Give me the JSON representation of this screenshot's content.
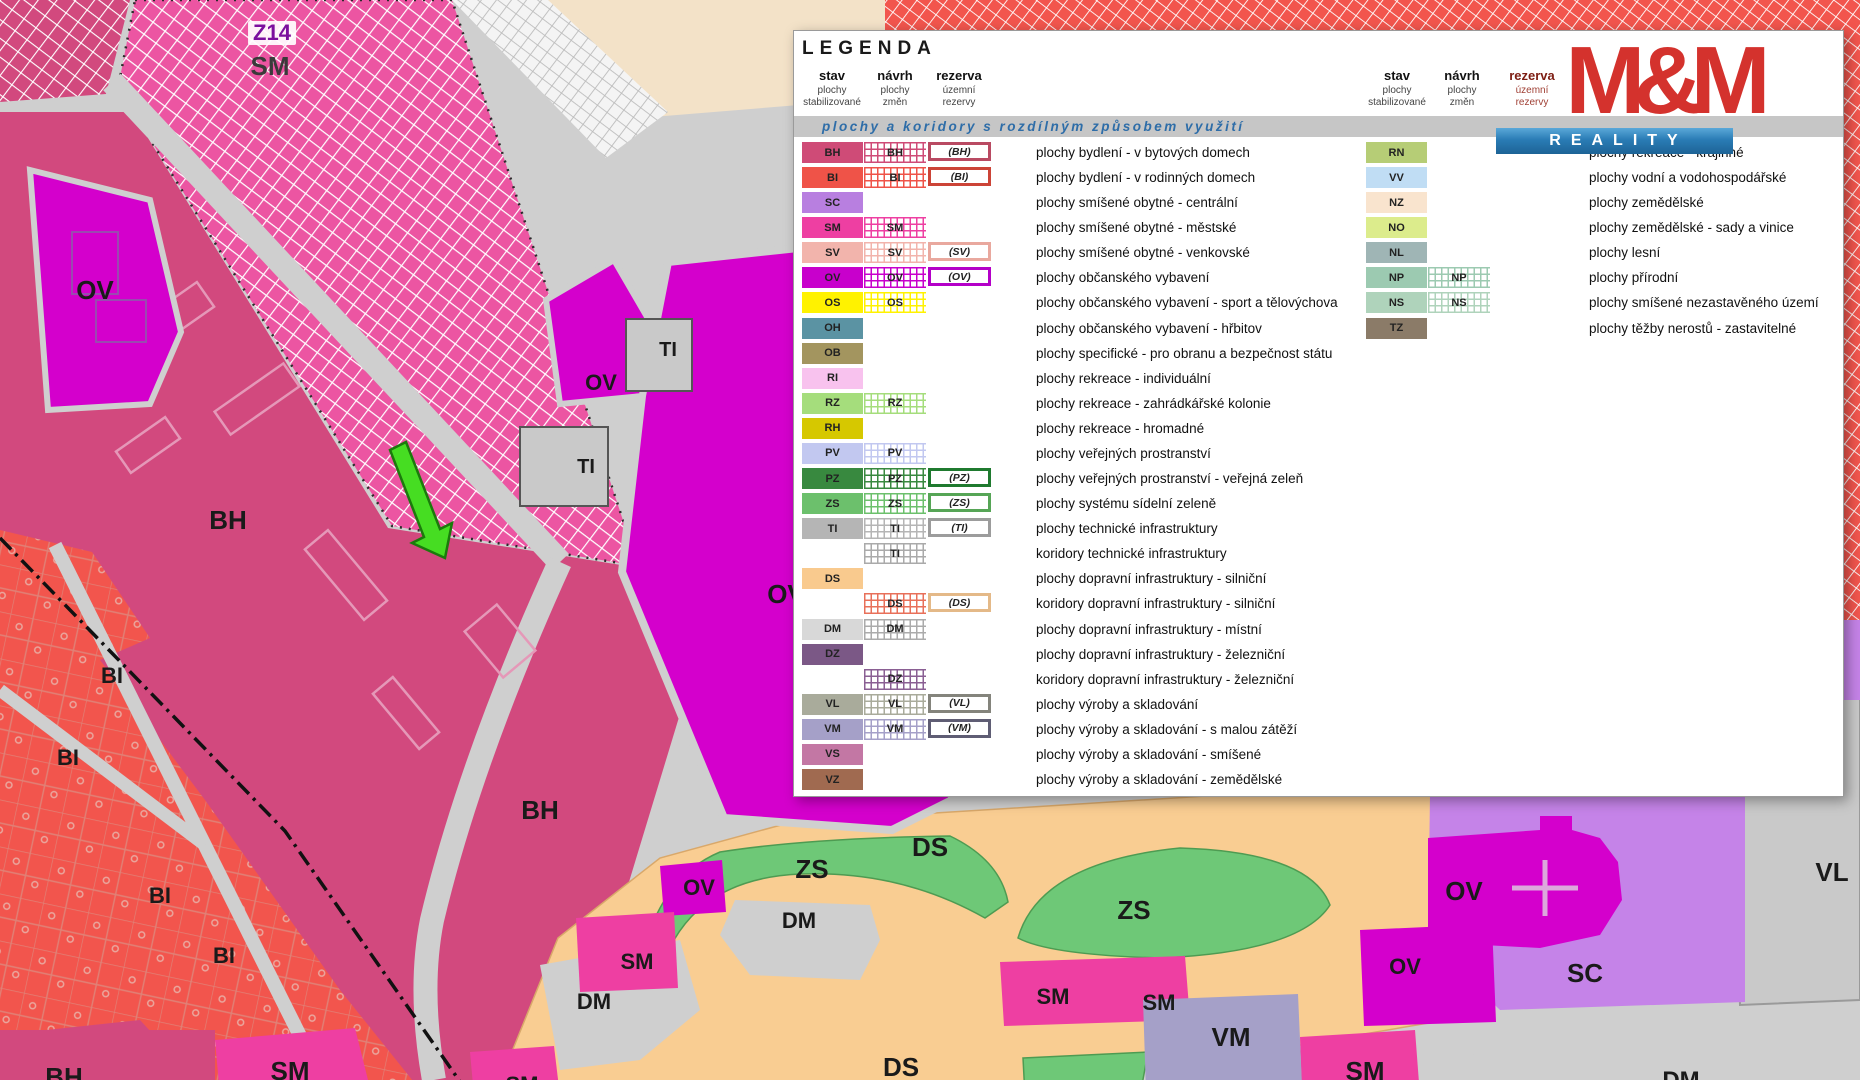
{
  "legend": {
    "title": "LEGENDA",
    "band_text": "plochy a koridory s rozdílným způsobem využití",
    "band_bg": "#c6c6c6",
    "band_text_color": "#2e6da8",
    "columns": {
      "stav": [
        "stav",
        "plochy",
        "stabilizované"
      ],
      "navrh": [
        "návrh",
        "plochy",
        "změn"
      ],
      "rezerva": [
        "rezerva",
        "územní",
        "rezervy"
      ]
    },
    "left_rows": [
      {
        "c": "BH",
        "s": 1,
        "n": 1,
        "r": 1,
        "rc": "#b94a62",
        "d": "plochy bydlení - v bytových domech"
      },
      {
        "c": "BI",
        "s": 1,
        "n": 1,
        "r": 1,
        "rc": "#cc4437",
        "d": "plochy bydlení - v rodinných domech"
      },
      {
        "c": "SC",
        "s": 1,
        "n": 0,
        "r": 0,
        "d": "plochy smíšené obytné - centrální"
      },
      {
        "c": "SM",
        "s": 1,
        "n": 1,
        "r": 0,
        "d": "plochy smíšené obytné - městské"
      },
      {
        "c": "SV",
        "s": 1,
        "n": 1,
        "r": 1,
        "rc": "#e9a89e",
        "d": "plochy smíšené obytné - venkovské"
      },
      {
        "c": "OV",
        "s": 1,
        "n": 1,
        "r": 1,
        "rc": "#b400c8",
        "d": "plochy občanského vybavení"
      },
      {
        "c": "OS",
        "s": 1,
        "n": 1,
        "r": 0,
        "d": "plochy občanského vybavení - sport a tělovýchova"
      },
      {
        "c": "OH",
        "s": 1,
        "n": 0,
        "r": 0,
        "d": "plochy občanského vybavení - hřbitov"
      },
      {
        "c": "OB",
        "s": 1,
        "n": 0,
        "r": 0,
        "d": "plochy specifické - pro obranu a bezpečnost státu"
      },
      {
        "c": "RI",
        "s": 1,
        "n": 0,
        "r": 0,
        "d": "plochy rekreace - individuální"
      },
      {
        "c": "RZ",
        "s": 1,
        "n": 1,
        "r": 0,
        "d": "plochy rekreace - zahrádkářské kolonie"
      },
      {
        "c": "RH",
        "s": 1,
        "n": 0,
        "r": 0,
        "d": "plochy rekreace - hromadné"
      },
      {
        "c": "PV",
        "s": 1,
        "n": 1,
        "r": 0,
        "d": "plochy veřejných prostranství"
      },
      {
        "c": "PZ",
        "s": 1,
        "n": 1,
        "r": 1,
        "rc": "#1f7a2f",
        "d": "plochy veřejných prostranství - veřejná zeleň"
      },
      {
        "c": "ZS",
        "s": 1,
        "n": 1,
        "r": 1,
        "rc": "#56a556",
        "d": "plochy systému sídelní zeleně"
      },
      {
        "c": "TI",
        "s": 1,
        "n": 1,
        "r": 1,
        "rc": "#9c9c9c",
        "d": "plochy technické infrastruktury"
      },
      {
        "c": "TI",
        "s": 0,
        "n": 1,
        "r": 0,
        "hc": "#aaaaaa",
        "d": "koridory technické infrastruktury"
      },
      {
        "c": "DS",
        "s": 1,
        "n": 0,
        "r": 0,
        "d": "plochy dopravní infrastruktury - silniční"
      },
      {
        "c": "DS",
        "s": 0,
        "n": 1,
        "r": 1,
        "hc": "#e8705a",
        "rc": "#e4b988",
        "d": "koridory dopravní infrastruktury - silniční"
      },
      {
        "c": "DM",
        "s": 1,
        "n": 1,
        "r": 0,
        "hc": "#ababab",
        "d": "plochy dopravní infrastruktury - místní"
      },
      {
        "c": "DZ",
        "s": 1,
        "n": 0,
        "r": 0,
        "d": "plochy dopravní infrastruktury - železniční"
      },
      {
        "c": "DZ",
        "s": 0,
        "n": 1,
        "r": 0,
        "hc": "#8a5f93",
        "d": "koridory dopravní infrastruktury - železniční"
      },
      {
        "c": "VL",
        "s": 1,
        "n": 1,
        "r": 1,
        "rc": "#84847c",
        "d": "plochy výroby a skladování"
      },
      {
        "c": "VM",
        "s": 1,
        "n": 1,
        "r": 1,
        "rc": "#5f5d74",
        "d": "plochy výroby a skladování - s malou zátěží"
      },
      {
        "c": "VS",
        "s": 1,
        "n": 0,
        "r": 0,
        "d": "plochy výroby a skladování - smíšené"
      },
      {
        "c": "VZ",
        "s": 1,
        "n": 0,
        "r": 0,
        "d": "plochy výroby a skladování - zemědělské"
      }
    ],
    "right_rows": [
      {
        "c": "RN",
        "s": 1,
        "n": 0,
        "d": "plochy rekreace - krajinné"
      },
      {
        "c": "VV",
        "s": 1,
        "n": 0,
        "d": "plochy vodní a vodohospodářské"
      },
      {
        "c": "NZ",
        "s": 1,
        "n": 0,
        "d": "plochy zemědělské"
      },
      {
        "c": "NO",
        "s": 1,
        "n": 0,
        "d": "plochy zemědělské - sady a vinice"
      },
      {
        "c": "NL",
        "s": 1,
        "n": 0,
        "d": "plochy lesní"
      },
      {
        "c": "NP",
        "s": 1,
        "n": 1,
        "d": "plochy přírodní"
      },
      {
        "c": "NS",
        "s": 1,
        "n": 1,
        "d": "plochy smíšené nezastavěného území"
      },
      {
        "c": "TZ",
        "s": 1,
        "n": 0,
        "d": "plochy těžby nerostů - zastavitelné"
      }
    ]
  },
  "logo": {
    "title": "M&M",
    "subtitle": "REALITY",
    "red": "#d4322d",
    "blue": "#2a7cb5"
  },
  "map": {
    "zone_colors": {
      "BH": "#cf4b77",
      "BI": "#ef5348",
      "SC": "#b87fe0",
      "SM": "#ee3fa2",
      "SV": "#f2b4ac",
      "OV": "#c800cc",
      "OS": "#fff200",
      "OH": "#5b93a3",
      "OB": "#a3955f",
      "RI": "#f8c2ee",
      "RZ": "#a5dd7c",
      "RH": "#d6c800",
      "PV": "#c2c8f0",
      "PZ": "#38893f",
      "ZS": "#6cc06c",
      "TI": "#b5b5b5",
      "DS": "#f9ca8e",
      "DM": "#d8d8d8",
      "DZ": "#7b5886",
      "VL": "#a9ab9b",
      "VM": "#a5a0c8",
      "VS": "#c377a4",
      "VZ": "#a06a50",
      "RN": "#b6cd76",
      "VV": "#c0ddf4",
      "NZ": "#f9e4ce",
      "NO": "#dcec8c",
      "NL": "#9fb5b5",
      "NP": "#9ccab1",
      "NS": "#afd3bb",
      "TZ": "#8b7b68",
      "road": "#cfcfcf",
      "beige": "#f3e2c8",
      "bh_map": "#d2497e",
      "sm_map": "#ee3fa2",
      "sm_hatch_bg": "#ec55a2",
      "bi_map": "#f2554d",
      "ov_map": "#d400cc",
      "sc_map": "#c583e8",
      "vm_map": "#a5a0c8",
      "vl_map": "#c9c9c9",
      "ds_map": "#f9cd92",
      "zs_map": "#6ec877",
      "arrow": "#46dd22",
      "arrow_edge": "#1b7a0c",
      "cross": "#dca8dc"
    },
    "labels": [
      {
        "t": "Z14",
        "x": 272,
        "y": 33,
        "c": "#7b0f9e",
        "s": 22,
        "chip": true
      },
      {
        "t": "SM",
        "x": 270,
        "y": 66,
        "c": "#3a3a3a"
      },
      {
        "t": "OV",
        "x": 95,
        "y": 290
      },
      {
        "t": "OV",
        "x": 601,
        "y": 383,
        "s": 22
      },
      {
        "t": "TI",
        "x": 668,
        "y": 350,
        "s": 20
      },
      {
        "t": "TI",
        "x": 586,
        "y": 467,
        "s": 20
      },
      {
        "t": "BH",
        "x": 228,
        "y": 520
      },
      {
        "t": "OV",
        "x": 786,
        "y": 594
      },
      {
        "t": "BI",
        "x": 112,
        "y": 676,
        "s": 22
      },
      {
        "t": "BI",
        "x": 68,
        "y": 758,
        "s": 22
      },
      {
        "t": "BI",
        "x": 160,
        "y": 896,
        "s": 22
      },
      {
        "t": "BI",
        "x": 224,
        "y": 956,
        "s": 22
      },
      {
        "t": "BH",
        "x": 540,
        "y": 810
      },
      {
        "t": "DS",
        "x": 930,
        "y": 847
      },
      {
        "t": "ZS",
        "x": 812,
        "y": 869
      },
      {
        "t": "OV",
        "x": 699,
        "y": 888,
        "s": 22
      },
      {
        "t": "DM",
        "x": 799,
        "y": 921,
        "s": 22
      },
      {
        "t": "SM",
        "x": 637,
        "y": 962,
        "s": 22
      },
      {
        "t": "DM",
        "x": 594,
        "y": 1002,
        "s": 22
      },
      {
        "t": "ZS",
        "x": 1134,
        "y": 910
      },
      {
        "t": "SM",
        "x": 1053,
        "y": 997,
        "s": 22
      },
      {
        "t": "SM",
        "x": 1159,
        "y": 1003,
        "s": 22
      },
      {
        "t": "VM",
        "x": 1231,
        "y": 1037
      },
      {
        "t": "DS",
        "x": 901,
        "y": 1067
      },
      {
        "t": "SM",
        "x": 290,
        "y": 1071
      },
      {
        "t": "BH",
        "x": 64,
        "y": 1077
      },
      {
        "t": "SM",
        "x": 522,
        "y": 1085,
        "s": 22
      },
      {
        "t": "OV",
        "x": 1464,
        "y": 891
      },
      {
        "t": "OV",
        "x": 1405,
        "y": 967,
        "s": 22
      },
      {
        "t": "SM",
        "x": 1365,
        "y": 1071
      },
      {
        "t": "SC",
        "x": 1585,
        "y": 973
      },
      {
        "t": "VL",
        "x": 1832,
        "y": 872
      },
      {
        "t": "DM",
        "x": 1681,
        "y": 1081,
        "s": 24
      }
    ]
  }
}
